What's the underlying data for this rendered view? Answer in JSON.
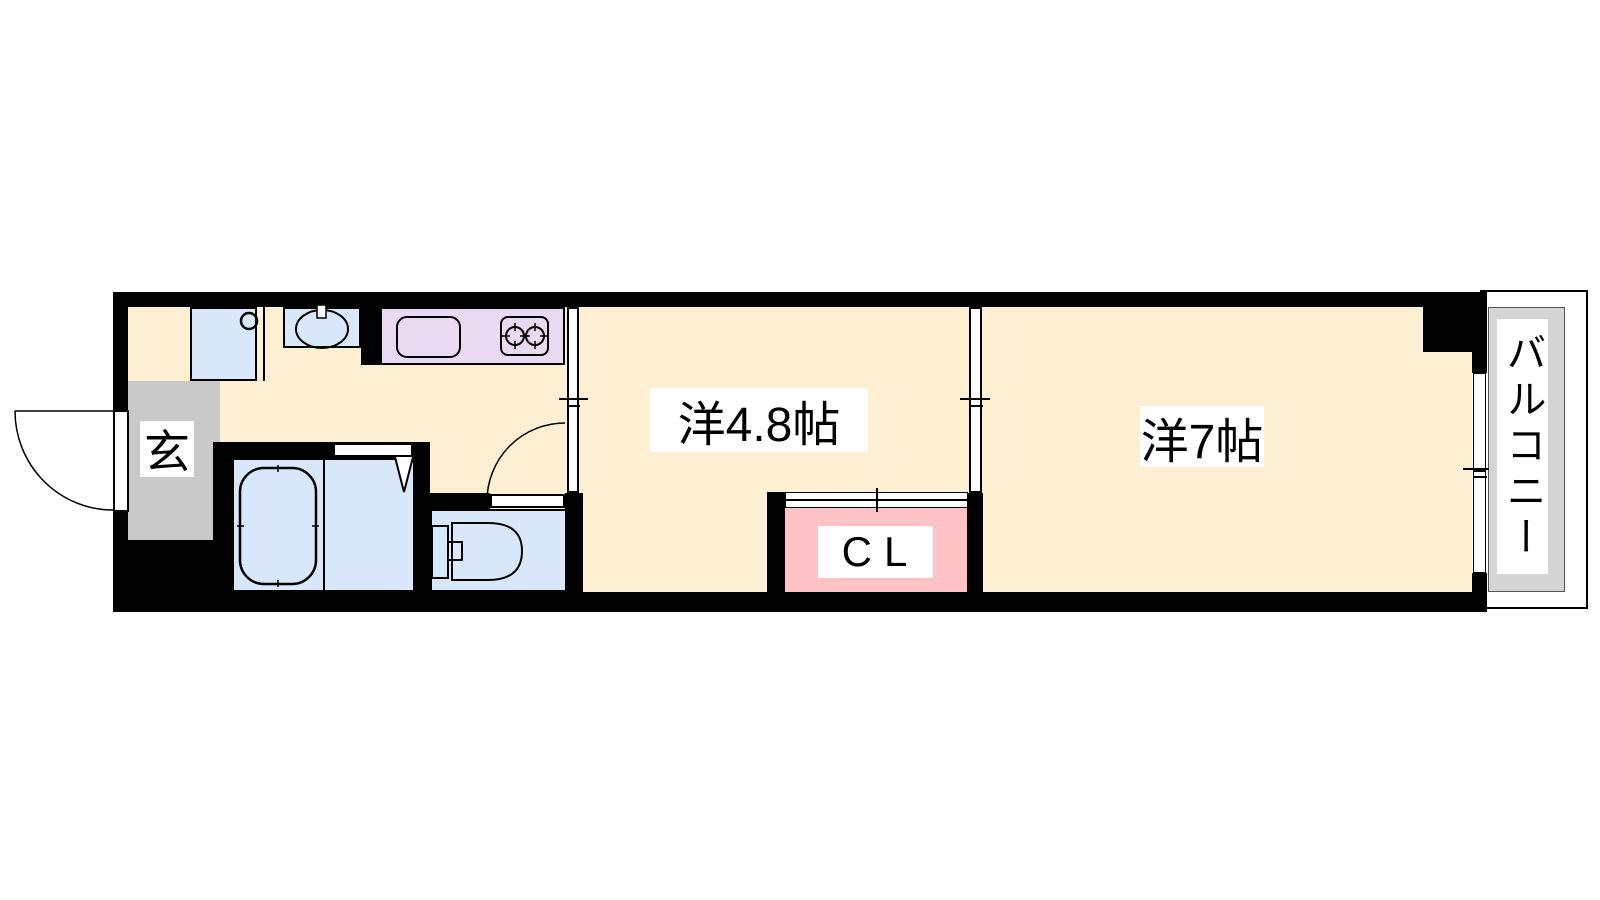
{
  "plan": {
    "type": "floor-plan",
    "rooms": {
      "genkan": {
        "label": "玄"
      },
      "western_room_1": {
        "label": "洋4.8帖"
      },
      "western_room_2": {
        "label": "洋7帖"
      },
      "closet": {
        "label": "CL"
      },
      "balcony": {
        "label": "バルコニー"
      }
    },
    "fixtures": [
      "washer-pan",
      "washbasin",
      "kitchen-sink",
      "gas-stove-2-burner",
      "bathtub",
      "toilet",
      "entry-door",
      "toilet-door",
      "folding-bath-door",
      "closet-sliding-door",
      "balcony-window"
    ]
  },
  "colors": {
    "wall": "#000000",
    "floor": "#FCEFD2",
    "water": "#D8E8FA",
    "kitchen": "#EADAF1",
    "closet": "#FFC2C5",
    "genkan": "#C9C9C9",
    "balcony": "#D5D5D5"
  }
}
